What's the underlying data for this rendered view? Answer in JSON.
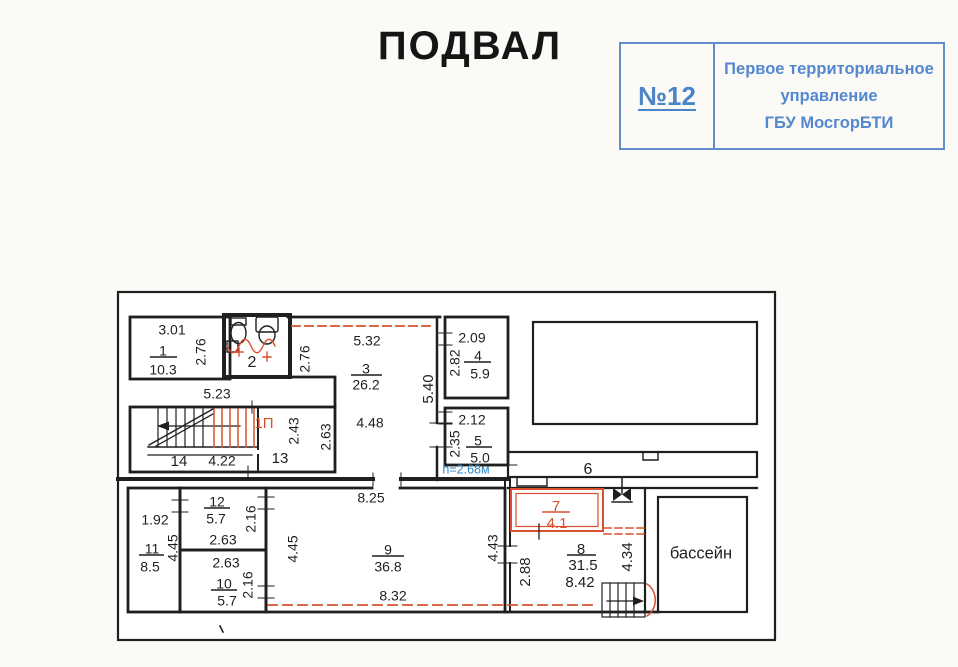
{
  "header": {
    "title": "ПОДВАЛ"
  },
  "stamp": {
    "number": "№12",
    "org_lines": [
      "Первое территориальное",
      "управление",
      "ГБУ МосгорБТИ"
    ],
    "color": "#4b84c9"
  },
  "plan": {
    "floor_name": "ПОДВАЛ",
    "height_note": "h=2.68м",
    "pool_label": "бассейн",
    "colors": {
      "walls": "#1f1f1f",
      "red": "#d8502f",
      "blue": "#2f86c8"
    },
    "labels": [
      {
        "id": "r1-w",
        "t": "3.01",
        "x": 172,
        "y": 331
      },
      {
        "id": "r1-num",
        "t": "1",
        "x": 163,
        "y": 352,
        "bar": [
          150,
          177,
          357
        ]
      },
      {
        "id": "r1-area",
        "t": "10.3",
        "x": 163,
        "y": 371
      },
      {
        "id": "r1-h",
        "t": "2.76",
        "x": 202,
        "y": 352,
        "r": 1
      },
      {
        "id": "r2-num",
        "t": "2",
        "x": 252,
        "y": 363,
        "s": 16
      },
      {
        "id": "corr-523",
        "t": "5.23",
        "x": 217,
        "y": 395
      },
      {
        "id": "r3-w",
        "t": "5.32",
        "x": 367,
        "y": 342
      },
      {
        "id": "r3-h1",
        "t": "2.76",
        "x": 306,
        "y": 359,
        "r": 1
      },
      {
        "id": "r3-num",
        "t": "3",
        "x": 366,
        "y": 370,
        "bar": [
          351,
          382,
          375
        ]
      },
      {
        "id": "r3-area",
        "t": "26.2",
        "x": 366,
        "y": 386
      },
      {
        "id": "r3-448",
        "t": "4.48",
        "x": 370,
        "y": 424
      },
      {
        "id": "r3-263",
        "t": "2.63",
        "x": 327,
        "y": 437,
        "r": 1
      },
      {
        "id": "stair-1p",
        "t": "1П",
        "x": 264,
        "y": 424,
        "c": "red",
        "s": 15
      },
      {
        "id": "r13-243",
        "t": "2.43",
        "x": 295,
        "y": 431,
        "r": 1
      },
      {
        "id": "r13-num",
        "t": "13",
        "x": 280,
        "y": 459,
        "s": 15
      },
      {
        "id": "r14-num",
        "t": "14",
        "x": 179,
        "y": 462,
        "s": 15
      },
      {
        "id": "r14-422",
        "t": "4.22",
        "x": 222,
        "y": 462
      },
      {
        "id": "w34-540",
        "t": "5.40",
        "x": 429,
        "y": 389,
        "r": 1,
        "s": 15
      },
      {
        "id": "r4-w",
        "t": "2.09",
        "x": 472,
        "y": 339
      },
      {
        "id": "r4-h",
        "t": "2.82",
        "x": 456,
        "y": 363,
        "r": 1
      },
      {
        "id": "r4-num",
        "t": "4",
        "x": 478,
        "y": 357,
        "bar": [
          464,
          491,
          362
        ]
      },
      {
        "id": "r4-area",
        "t": "5.9",
        "x": 480,
        "y": 375
      },
      {
        "id": "r5-w",
        "t": "2.12",
        "x": 472,
        "y": 421
      },
      {
        "id": "r5-h",
        "t": "2.35",
        "x": 456,
        "y": 444,
        "r": 1
      },
      {
        "id": "r5-num",
        "t": "5",
        "x": 478,
        "y": 442,
        "bar": [
          466,
          492,
          447
        ]
      },
      {
        "id": "r5-area",
        "t": "5.0",
        "x": 480,
        "y": 459
      },
      {
        "id": "r5-height",
        "t": "h=2.68м",
        "x": 466,
        "y": 470,
        "c": "blue",
        "s": 12.5
      },
      {
        "id": "r6-num",
        "t": "6",
        "x": 588,
        "y": 470,
        "s": 16
      },
      {
        "id": "r11-w",
        "t": "1.92",
        "x": 155,
        "y": 521
      },
      {
        "id": "r11-num",
        "t": "11",
        "x": 152,
        "y": 550,
        "bar": [
          139,
          164,
          555
        ]
      },
      {
        "id": "r11-area",
        "t": "8.5",
        "x": 150,
        "y": 568
      },
      {
        "id": "r11-h",
        "t": "4.45",
        "x": 174,
        "y": 548,
        "r": 1
      },
      {
        "id": "r12-num",
        "t": "12",
        "x": 217,
        "y": 503,
        "bar": [
          204,
          230,
          508
        ]
      },
      {
        "id": "r12-area",
        "t": "5.7",
        "x": 216,
        "y": 520
      },
      {
        "id": "r12-w",
        "t": "2.63",
        "x": 223,
        "y": 541
      },
      {
        "id": "r12-h",
        "t": "2.16",
        "x": 252,
        "y": 519,
        "r": 1
      },
      {
        "id": "r10-w",
        "t": "2.63",
        "x": 226,
        "y": 564
      },
      {
        "id": "r10-num",
        "t": "10",
        "x": 224,
        "y": 585,
        "bar": [
          211,
          237,
          590
        ]
      },
      {
        "id": "r10-area",
        "t": "5.7",
        "x": 227,
        "y": 602
      },
      {
        "id": "r10-h",
        "t": "2.16",
        "x": 249,
        "y": 585,
        "r": 1
      },
      {
        "id": "r9-w1",
        "t": "8.25",
        "x": 371,
        "y": 499
      },
      {
        "id": "r9-h1",
        "t": "4.45",
        "x": 294,
        "y": 549,
        "r": 1
      },
      {
        "id": "r9-num",
        "t": "9",
        "x": 388,
        "y": 551,
        "bar": [
          372,
          404,
          556
        ]
      },
      {
        "id": "r9-area",
        "t": "36.8",
        "x": 388,
        "y": 568
      },
      {
        "id": "r9-w2",
        "t": "8.32",
        "x": 393,
        "y": 597
      },
      {
        "id": "r9-h2",
        "t": "4.43",
        "x": 494,
        "y": 548,
        "r": 1
      },
      {
        "id": "r7-num",
        "t": "7",
        "x": 556,
        "y": 507,
        "c": "red",
        "bar": [
          542,
          570,
          512
        ],
        "s": 15
      },
      {
        "id": "r7-area",
        "t": "4.1",
        "x": 557,
        "y": 524,
        "c": "red",
        "s": 15
      },
      {
        "id": "r8-num",
        "t": "8",
        "x": 581,
        "y": 550,
        "bar": [
          567,
          596,
          555
        ],
        "s": 15
      },
      {
        "id": "r8-area",
        "t": "31.5",
        "x": 583,
        "y": 566,
        "s": 15
      },
      {
        "id": "r8-w",
        "t": "8.42",
        "x": 580,
        "y": 583,
        "s": 15
      },
      {
        "id": "r8-h1",
        "t": "2.88",
        "x": 526,
        "y": 572,
        "r": 1,
        "s": 15
      },
      {
        "id": "r8-h2",
        "t": "4.34",
        "x": 628,
        "y": 557,
        "r": 1,
        "s": 15
      },
      {
        "id": "pool-label",
        "t": "бассейн",
        "x": 701,
        "y": 554,
        "s": 16.5
      }
    ]
  }
}
